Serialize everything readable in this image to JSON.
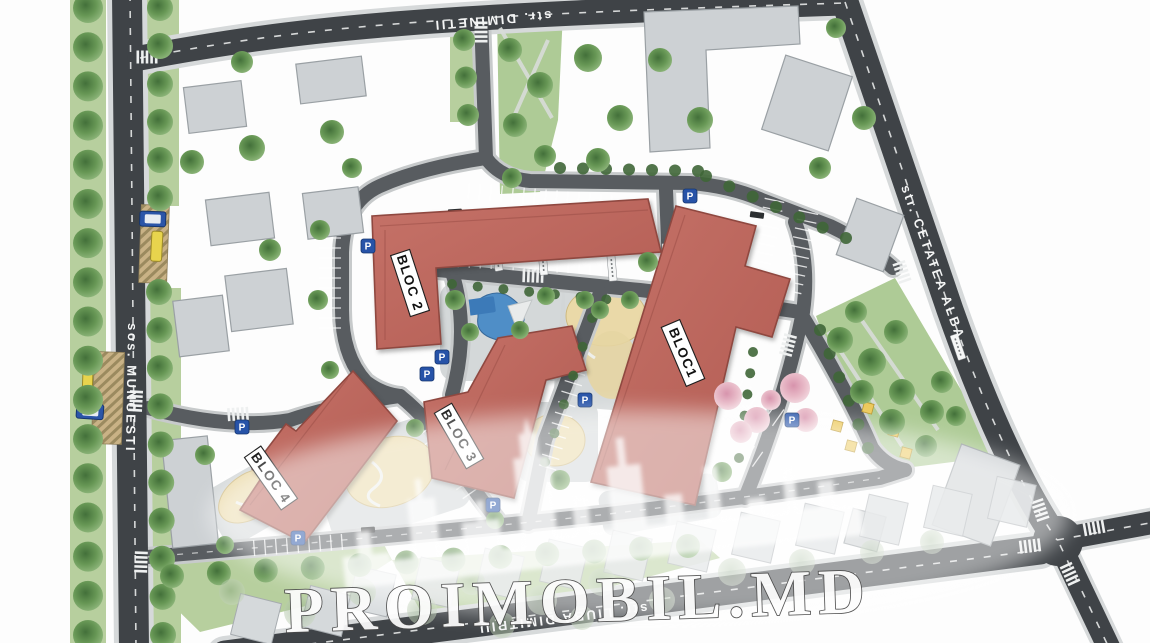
{
  "map": {
    "watermark_text": "PROIMOBIL.MD",
    "streets": [
      {
        "id": "diminetii",
        "label": "str. DIMINETII"
      },
      {
        "id": "muncesti",
        "label": "sos. MUNCESTI"
      },
      {
        "id": "cetatea-alba",
        "label": "str. CETATEA ALBA"
      },
      {
        "id": "liuba-dimitriu",
        "label": "str. LIUBA DIMITRIU"
      }
    ],
    "blocks": [
      {
        "id": "bloc-1",
        "label": "BLOC1"
      },
      {
        "id": "bloc-2",
        "label": "BLOC 2"
      },
      {
        "id": "bloc-3",
        "label": "BLOC 3"
      },
      {
        "id": "bloc-4",
        "label": "BLOC 4"
      }
    ],
    "parking_sign": {
      "label": "P"
    },
    "colors": {
      "residential_block": "#bf6a60",
      "context_building": "#cdd1d4",
      "road_dark": "#3f4347",
      "road_internal": "#585c60",
      "lawn": "#b7cf9e",
      "tree_green": "#5d8a4c",
      "playground_sand": "#ead9a8",
      "playground_water": "#4f8ec7",
      "flowering_tree": "#e9bcc9",
      "bus_yellow": "#e8d44d",
      "trolleybus_blue": "#2b55a8",
      "parking_sign_blue": "#2753a8"
    }
  }
}
